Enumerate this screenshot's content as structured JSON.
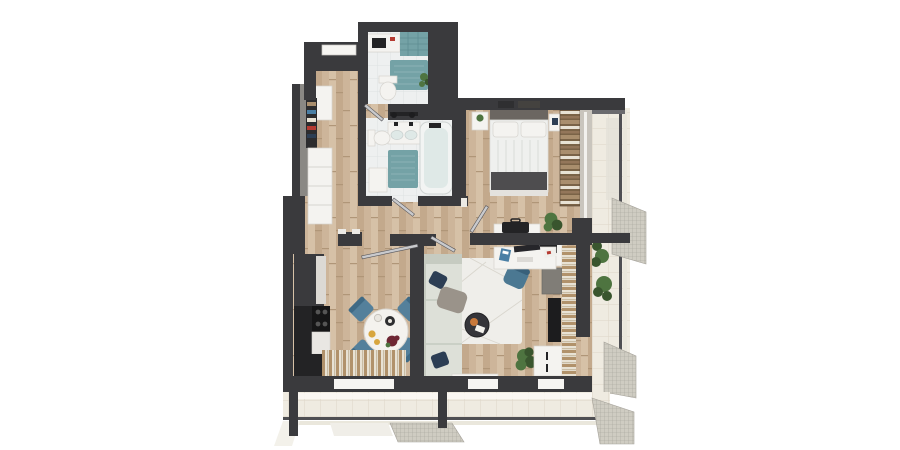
{
  "scene": {
    "type": "3d-apartment-floor-plan-top-down-render",
    "background": "#ffffff"
  },
  "palette": {
    "bg": "#ffffff",
    "wall": "#3a3a3d",
    "wallSoft": "#57575c",
    "wood1": "#cdb59a",
    "wood2": "#c3a98c",
    "wood3": "#d6c1a7",
    "woodLine": "#b09678",
    "tile": "#eef0f0",
    "tileLine": "#dde2e2",
    "teal": "#74a2a6",
    "tealDeep": "#5e8d92",
    "white": "#f4f3f0",
    "whiteLine": "#d6d4cf",
    "cream": "#e9dfc9",
    "tanCurtain": "#b1926b",
    "sofa": "#dde0d8",
    "sofaBack": "#c6cbc1",
    "sofaLine": "#c0c5ba",
    "navy": "#2c3e54",
    "chair": "#54809b",
    "rug": "#efeeea",
    "rugLine": "#d9d6ce",
    "dark": "#232325",
    "gray": "#8a8884",
    "balcony": "#efebe1",
    "balconyLine": "#ddd6c7",
    "rail": "#4f4f53",
    "railLight": "#eae7dc",
    "mesh": "#cfccc2",
    "meshLine": "#a5a29a",
    "plant": "#4e7440",
    "plantDeep": "#39552e",
    "wine": "#6e2633",
    "orange": "#c8793b",
    "yellow": "#d8a63f",
    "red": "#b53a31",
    "marble": "#e9e7e3",
    "glass": "#dfe9e7",
    "glassBlue": "#cfdee0",
    "metal": "#c9cacd",
    "brown": "#7a6347",
    "brown2": "#a98e6d",
    "linen": "#e8e2d4"
  },
  "rooms": [
    {
      "name": "entry-hall",
      "furniture": [
        "entry-door",
        "entry-wardrobe",
        "open-closet-clothes",
        "drawer-unit"
      ]
    },
    {
      "name": "wc-laundry",
      "furniture": [
        "counter-sink",
        "teal-wall-tiles",
        "teal-mat",
        "toilet",
        "plant"
      ]
    },
    {
      "name": "bathroom",
      "furniture": [
        "shower-fixture",
        "double-sink",
        "toilet",
        "bathtub",
        "teal-mat",
        "cabinet"
      ]
    },
    {
      "name": "bedroom",
      "furniture": [
        "wall-art",
        "double-bed",
        "pillows",
        "dark-throw",
        "nightstand-left",
        "nightstand-right",
        "open-wardrobe",
        "foot-dresser",
        "luggage-bag",
        "corner-plant",
        "window"
      ]
    },
    {
      "name": "home-office-nook",
      "furniture": [
        "desk",
        "monitor",
        "keyboard",
        "papers",
        "office-chair"
      ]
    },
    {
      "name": "living-room",
      "furniture": [
        "corner-sofa",
        "navy-pillows",
        "throw-blanket",
        "rug",
        "coffee-table",
        "sideboard",
        "storage-cabinet",
        "tv",
        "tv-lowboard",
        "curtains",
        "plant",
        "window-bench"
      ]
    },
    {
      "name": "kitchen-dining",
      "furniture": [
        "tall-cabinet",
        "cooktop",
        "counter",
        "fridge",
        "dining-table",
        "dining-chairs",
        "flowers",
        "coffee-set",
        "curtains",
        "window"
      ]
    },
    {
      "name": "balcony-right",
      "furniture": [
        "railing",
        "mesh-panels",
        "plants",
        "divider-wall"
      ]
    },
    {
      "name": "balcony-bottom",
      "furniture": [
        "railing",
        "mesh-panels",
        "support-posts"
      ]
    }
  ]
}
